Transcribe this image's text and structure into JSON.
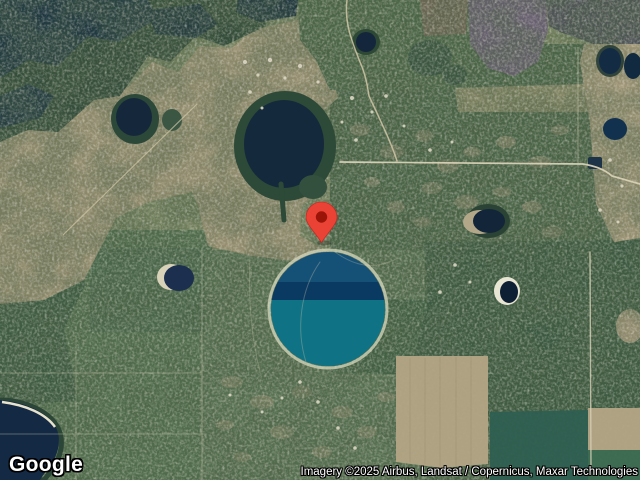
{
  "map_view": {
    "google_logo_text": "Google",
    "attribution_text": "Imagery ©2025 Airbus, Landsat / Copernicus, Maxar Technologies",
    "marker": {
      "type": "location-pin",
      "body_color": "#ea4335",
      "inner_dot_color": "#9a1507"
    },
    "colors": {
      "circular_lake_teal": "#0f7285",
      "circular_lake_mid_band": "#0a3a62",
      "circular_lake_top": "#155177",
      "dark_water": "#16293c",
      "terrain_tan": "#a39678",
      "field_green": "#53704f",
      "forest_green": "#3a5840",
      "forest_purple": "#6d6077",
      "road": "#d8d1b6",
      "sand_rim": "#d7dabf"
    }
  }
}
